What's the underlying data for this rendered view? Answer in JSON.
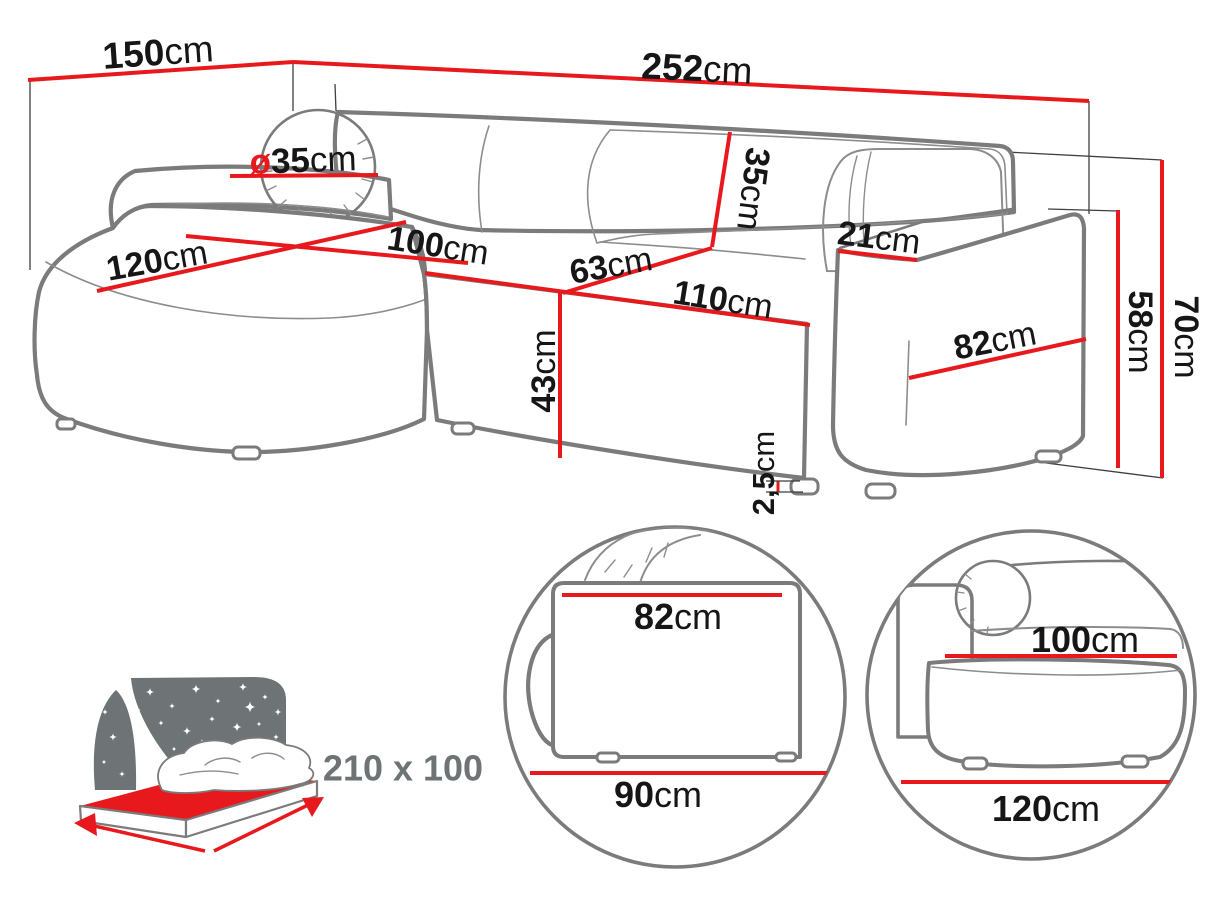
{
  "diagram": {
    "title": "corner-sofa-dimension-diagram",
    "colors": {
      "dimension_red": "#e8191d",
      "outline_gray": "#7b7b7b",
      "label_black": "#161616",
      "icon_gray": "#6e7376"
    },
    "dims": {
      "d150": {
        "num": "150",
        "unit": "cm"
      },
      "d252": {
        "num": "252",
        "unit": "cm"
      },
      "dia35": {
        "prefix": "ø",
        "num": "35",
        "unit": "cm"
      },
      "d120": {
        "num": "120",
        "unit": "cm"
      },
      "d100": {
        "num": "100",
        "unit": "cm"
      },
      "d63": {
        "num": "63",
        "unit": "cm"
      },
      "d110": {
        "num": "110",
        "unit": "cm"
      },
      "d35": {
        "num": "35",
        "unit": "cm"
      },
      "d21": {
        "num": "21",
        "unit": "cm"
      },
      "d82": {
        "num": "82",
        "unit": "cm"
      },
      "d43": {
        "num": "43",
        "unit": "cm"
      },
      "d2_5": {
        "num": "2,5",
        "unit": "cm"
      },
      "d58": {
        "num": "58",
        "unit": "cm"
      },
      "d70": {
        "num": "70",
        "unit": "cm"
      }
    },
    "sleeping_area": {
      "label": "210 x 100"
    },
    "detail_armrest": {
      "top": {
        "num": "82",
        "unit": "cm"
      },
      "bottom": {
        "num": "90",
        "unit": "cm"
      }
    },
    "detail_chaise": {
      "top": {
        "num": "100",
        "unit": "cm"
      },
      "bottom": {
        "num": "120",
        "unit": "cm"
      }
    }
  }
}
